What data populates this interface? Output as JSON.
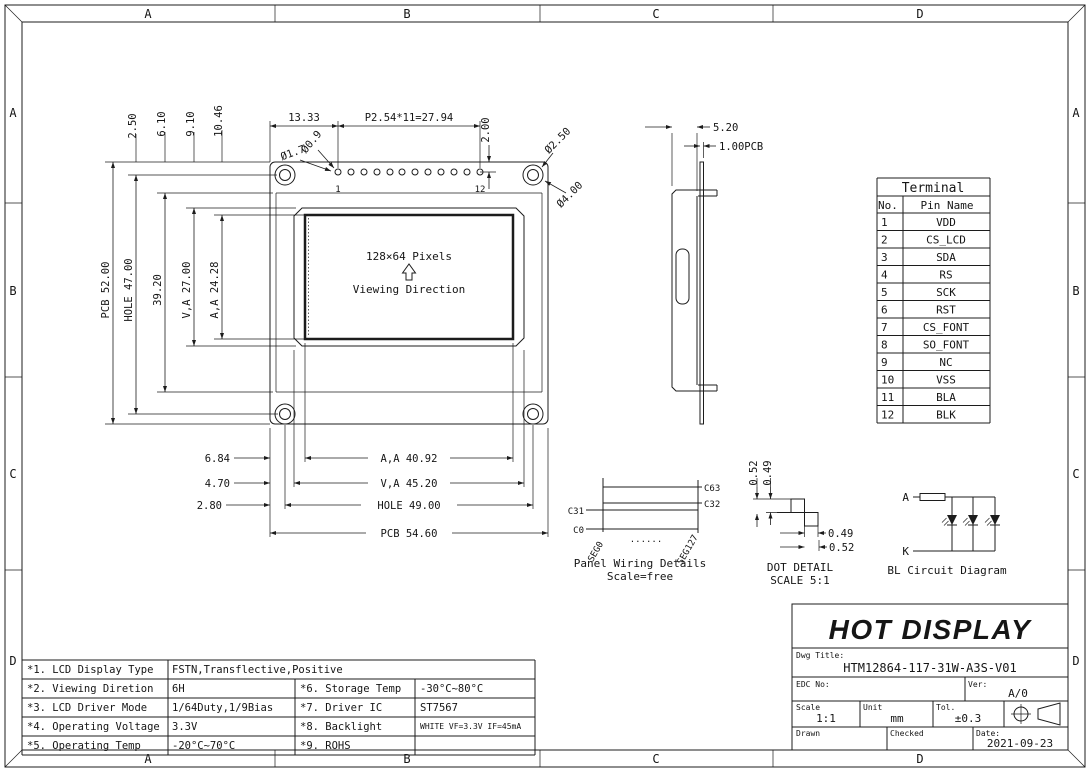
{
  "border": {
    "cols": [
      "A",
      "B",
      "C",
      "D"
    ],
    "rows": [
      "A",
      "B",
      "C",
      "D"
    ]
  },
  "front_view": {
    "pixels_note": "128×64 Pixels",
    "viewing_note": "Viewing Direction",
    "pin_first": "1",
    "pin_last": "12",
    "dims": {
      "pcb_h": "PCB 52.00",
      "hole_h": "HOLE 47.00",
      "d3920": "39.20",
      "va_h": "V,A 27.00",
      "aa_h": "A,A 24.28",
      "d250": "2.50",
      "d610": "6.10",
      "d910": "9.10",
      "d1046": "10.46",
      "d1333": "13.33",
      "pitch": "P2.54*11=27.94",
      "d200": "2.00",
      "pin_pad": "Ø1.7",
      "pin_hole": "Ø0.9",
      "mount_hole": "Ø2.50",
      "mount_pad": "Ø4.00",
      "d684": "6.84",
      "d470": "4.70",
      "d280": "2.80",
      "aa_w": "A,A 40.92",
      "va_w": "V,A 45.20",
      "hole_w": "HOLE 49.00",
      "pcb_w": "PCB 54.60"
    }
  },
  "side_view": {
    "thickness": "5.20",
    "pcb_t": "1.00PCB"
  },
  "terminal": {
    "title": "Terminal",
    "col_no": "No.",
    "col_name": "Pin Name",
    "rows": [
      {
        "no": "1",
        "name": "VDD"
      },
      {
        "no": "2",
        "name": "CS_LCD"
      },
      {
        "no": "3",
        "name": "SDA"
      },
      {
        "no": "4",
        "name": "RS"
      },
      {
        "no": "5",
        "name": "SCK"
      },
      {
        "no": "6",
        "name": "RST"
      },
      {
        "no": "7",
        "name": "CS_FONT"
      },
      {
        "no": "8",
        "name": "SO_FONT"
      },
      {
        "no": "9",
        "name": "NC"
      },
      {
        "no": "10",
        "name": "VSS"
      },
      {
        "no": "11",
        "name": "BLA"
      },
      {
        "no": "12",
        "name": "BLK"
      }
    ]
  },
  "panel_wiring": {
    "c63": "C63",
    "c32": "C32",
    "c31": "C31",
    "c0": "C0",
    "seg0": "SEG0",
    "seg127": "SEG127",
    "dots": "......",
    "caption": "Panel Wiring Details",
    "scale": "Scale=free"
  },
  "dot_detail": {
    "v052": "0.52",
    "v049": "0.49",
    "h049": "0.49",
    "h052": "0.52",
    "caption": "DOT DETAIL",
    "scale": "SCALE 5:1"
  },
  "bl_circuit": {
    "anode": "A",
    "cathode": "K",
    "caption": "BL Circuit Diagram"
  },
  "title_block": {
    "company": "HOT DISPLAY",
    "dwg_title_label": "Dwg Title:",
    "dwg_title": "HTM12864-117-31W-A3S-V01",
    "edc_label": "EDC No:",
    "ver_label": "Ver:",
    "ver": "A/0",
    "scale_label": "Scale",
    "scale": "1:1",
    "unit_label": "Unit",
    "unit": "mm",
    "tol_label": "Tol.",
    "tol": "±0.3",
    "drawn_label": "Drawn",
    "checked_label": "Checked",
    "date_label": "Date:",
    "date": "2021-09-23"
  },
  "specs": {
    "rows": [
      {
        "label": "*1. LCD Display Type",
        "value": "FSTN,Transflective,Positive",
        "label2": "",
        "value2": ""
      },
      {
        "label": "*2. Viewing Diretion",
        "value": "6H",
        "label2": "*6. Storage Temp",
        "value2": "-30°C~80°C"
      },
      {
        "label": "*3. LCD Driver Mode",
        "value": "1/64Duty,1/9Bias",
        "label2": "*7. Driver IC",
        "value2": "ST7567"
      },
      {
        "label": "*4. Operating Voltage",
        "value": "3.3V",
        "label2": "*8. Backlight",
        "value2": "WHITE VF=3.3V IF=45mA"
      },
      {
        "label": "*5. Operating Temp",
        "value": "-20°C~70°C",
        "label2": "*9. ROHS",
        "value2": ""
      }
    ]
  }
}
